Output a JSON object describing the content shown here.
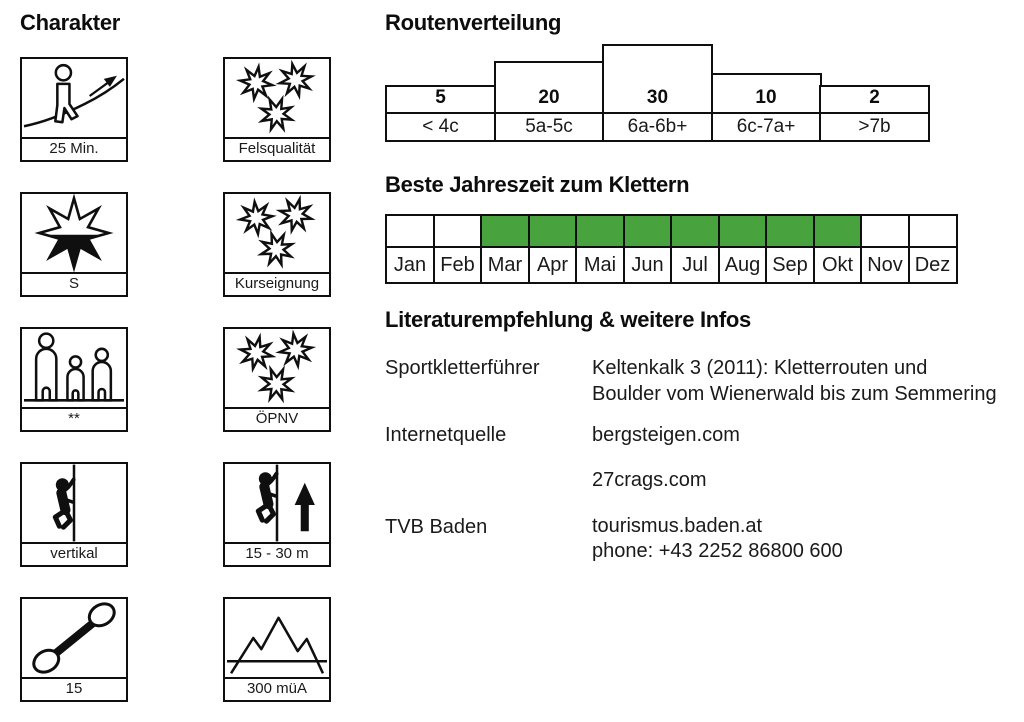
{
  "page": {
    "background": "#ffffff",
    "border_color": "#0f0f0f",
    "highlight_green": "#48a33e"
  },
  "chart_data": [
    {
      "type": "bar",
      "title": "Routenverteilung",
      "categories": [
        "< 4c",
        "5a-5c",
        "6a-6b+",
        "6c-7a+",
        ">7b"
      ],
      "values": [
        5,
        20,
        30,
        10,
        2
      ],
      "xlabel": "",
      "ylabel": "",
      "data_labels": "values shown inside base of each bar",
      "grid": false,
      "legend_position": "none"
    },
    {
      "type": "heatmap",
      "title": "Beste Jahreszeit zum Klettern",
      "categories": [
        "Jan",
        "Feb",
        "Mar",
        "Apr",
        "Mai",
        "Jun",
        "Jul",
        "Aug",
        "Sep",
        "Okt",
        "Nov",
        "Dez"
      ],
      "values": [
        0,
        0,
        1,
        1,
        1,
        1,
        1,
        1,
        1,
        1,
        0,
        0
      ],
      "highlight_color": "#48a33e",
      "grid": true,
      "legend_position": "none"
    }
  ],
  "charakter": {
    "heading": "Charakter",
    "boxes": [
      {
        "label": "25 Min.",
        "icon": "hiker-slope-icon"
      },
      {
        "label": "Felsqualität",
        "icon": "three-stars-icon"
      },
      {
        "label": "S",
        "icon": "half-filled-star-icon"
      },
      {
        "label": "Kurseignung",
        "icon": "three-stars-icon"
      },
      {
        "label": "**",
        "icon": "family-icon"
      },
      {
        "label": "ÖPNV",
        "icon": "three-stars-icon"
      },
      {
        "label": "vertikal",
        "icon": "climber-wall-icon"
      },
      {
        "label": "15 - 30 m",
        "icon": "climber-arrow-up-icon"
      },
      {
        "label": "15",
        "icon": "quickdraw-icon"
      },
      {
        "label": "300 müA",
        "icon": "mountains-icon"
      }
    ]
  },
  "routenverteilung": {
    "heading": "Routenverteilung",
    "columns": [
      {
        "count": "5",
        "grade": "< 4c",
        "bar_px": 29
      },
      {
        "count": "20",
        "grade": "5a-5c",
        "bar_px": 53
      },
      {
        "count": "30",
        "grade": "6a-6b+",
        "bar_px": 70
      },
      {
        "count": "10",
        "grade": "6c-7a+",
        "bar_px": 41
      },
      {
        "count": "2",
        "grade": ">7b",
        "bar_px": 29
      }
    ]
  },
  "jahreszeit": {
    "heading": "Beste Jahreszeit zum Klettern",
    "highlight_color": "#48a33e",
    "months": [
      {
        "label": "Jan",
        "best": false
      },
      {
        "label": "Feb",
        "best": false
      },
      {
        "label": "Mar",
        "best": true
      },
      {
        "label": "Apr",
        "best": true
      },
      {
        "label": "Mai",
        "best": true
      },
      {
        "label": "Jun",
        "best": true
      },
      {
        "label": "Jul",
        "best": true
      },
      {
        "label": "Aug",
        "best": true
      },
      {
        "label": "Sep",
        "best": true
      },
      {
        "label": "Okt",
        "best": true
      },
      {
        "label": "Nov",
        "best": false
      },
      {
        "label": "Dez",
        "best": false
      }
    ]
  },
  "literatur": {
    "heading": "Literaturempfehlung & weitere Infos",
    "rows": [
      {
        "label": "Sportkletterführer",
        "line1": "Keltenkalk 3 (2011): Kletterrouten und",
        "line2": "Boulder vom Wienerwald bis zum Semmering"
      },
      {
        "label": "Internetquelle",
        "line1": "bergsteigen.com",
        "line2": ""
      },
      {
        "label": "",
        "line1": "27crags.com",
        "line2": ""
      },
      {
        "label": "TVB Baden",
        "line1": "tourismus.baden.at",
        "line2": "phone: +43 2252 86800 600"
      }
    ]
  }
}
